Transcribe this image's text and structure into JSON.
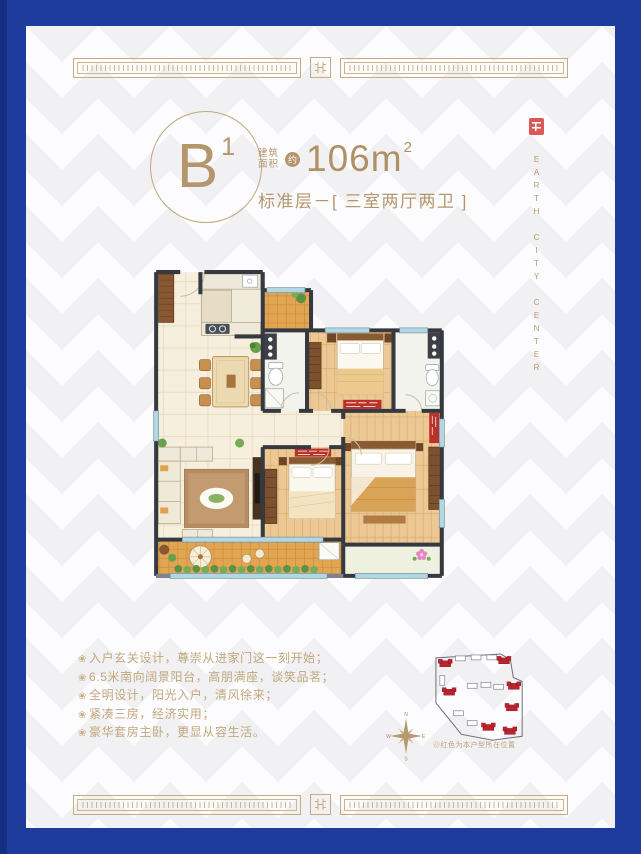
{
  "colors": {
    "frame_blue": "#1d3c9c",
    "gold": "#b3966b",
    "feature_tan": "#c1a87d",
    "seal_red": "#d95a58",
    "site_red": "#bc2330",
    "wood_floor": "#ecc994",
    "balcony_orange": "#e2a552",
    "wall_dark": "#363a40",
    "window_blue": "#b2d6e2"
  },
  "header": {
    "unit": "B",
    "unit_superscript": "1",
    "area_label_line1": "建筑",
    "area_label_line2": "面积",
    "approx_badge": "约",
    "area_value": "106m",
    "area_superscript": "2",
    "subtitle": "标准层－[ 三室两厅两卫 ]"
  },
  "brand": {
    "vertical_name": "EARTH CITY CENTER"
  },
  "features": {
    "bullet": "❀",
    "items": [
      "入户玄关设计，尊崇从进家门这一刻开始；",
      "6.5米南向阔景阳台，高朋满座，谈笑品茗；",
      "全明设计，阳光入户，清风徐来；",
      "紧凑三房，经济实用；",
      "豪华套房主卧，更显从容生活。"
    ]
  },
  "siteplan": {
    "caption_bullet": "❀",
    "caption": "红色为本户型所在位置",
    "compass": {
      "n": "N",
      "e": "E",
      "s": "S",
      "w": "W"
    }
  }
}
